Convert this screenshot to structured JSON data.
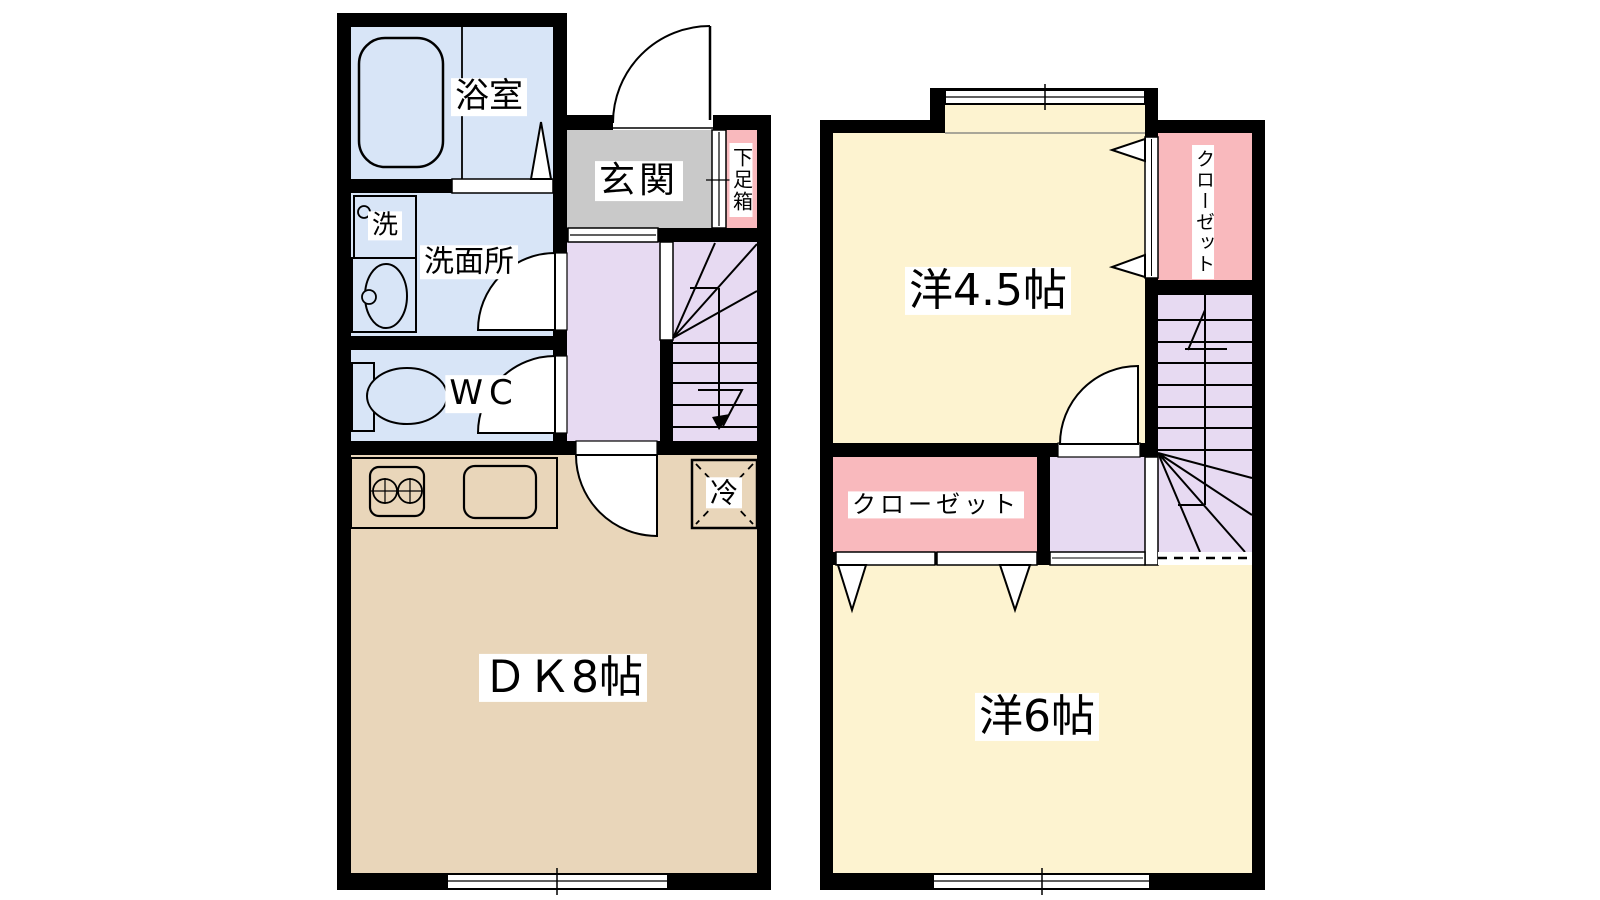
{
  "title": "2-story apartment floor plan (1DK + 2 rooms)",
  "palette": {
    "wet_area_blue": "#d8e5f7",
    "entrance_gray": "#c9c9c9",
    "closet_pink": "#f9b9bd",
    "hall_stairs_lavender": "#e7daf2",
    "dk_tan": "#e9d6ba",
    "bedroom_cream": "#fdf3d0",
    "wall_black": "#000000",
    "background_white": "#ffffff",
    "line_black": "#000000"
  },
  "floor1": {
    "rooms": {
      "bathroom": {
        "label": "浴室"
      },
      "laundry": {
        "label": "洗"
      },
      "washroom": {
        "label": "洗面所"
      },
      "wc": {
        "label": "WC"
      },
      "entrance": {
        "label": "玄関"
      },
      "shoe_box": {
        "label": "下足箱"
      },
      "dining_kitchen": {
        "label": "ＤＫ8帖"
      },
      "refrigerator": {
        "label": "冷"
      }
    }
  },
  "floor2": {
    "rooms": {
      "western_room_45": {
        "label": "洋4.5帖"
      },
      "closet_upper": {
        "label": "クローゼット"
      },
      "closet_lower": {
        "label": "クローゼット"
      },
      "western_room_6": {
        "label": "洋6帖"
      }
    }
  }
}
